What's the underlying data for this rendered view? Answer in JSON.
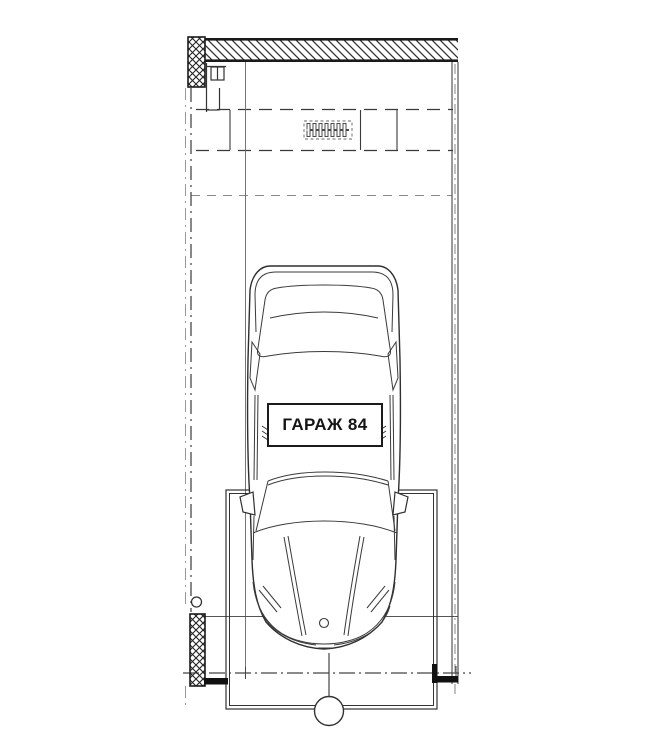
{
  "drawing": {
    "room_label": "ГАРАЖ 84"
  },
  "colors": {
    "ink": "#2e2e2e",
    "ink_light": "#8a8a8a",
    "paper": "#ffffff"
  }
}
